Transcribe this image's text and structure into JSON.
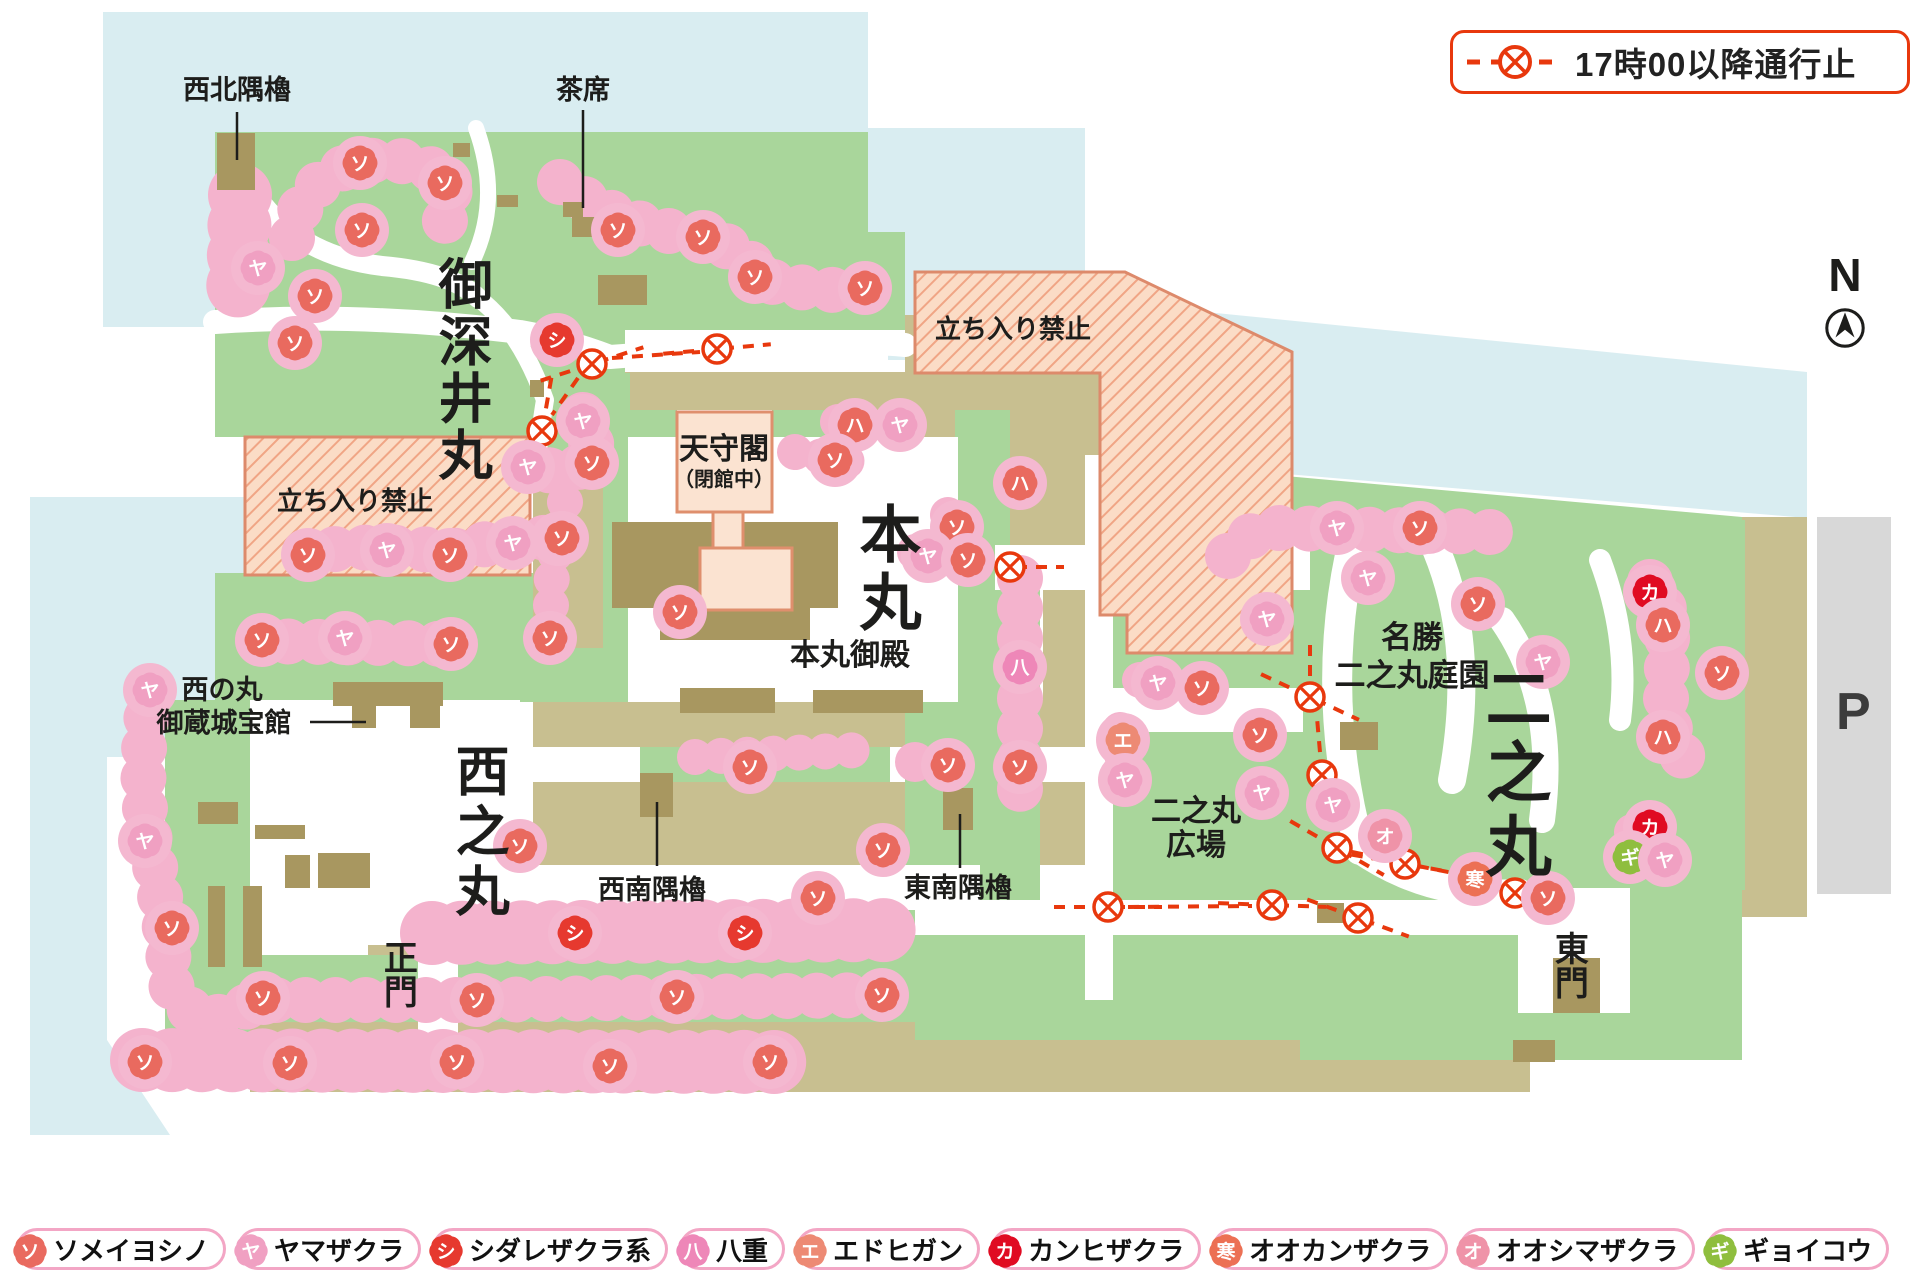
{
  "notice": {
    "label": "17時00以降通行止"
  },
  "compass": {
    "label": "N"
  },
  "parking": {
    "label": "P"
  },
  "labels": {
    "seihoku": "西北隅櫓",
    "chaseki": "茶席",
    "ofukemaru": "御深井丸",
    "no_entry": "立ち入り禁止",
    "tenshukaku": "天守閣",
    "tenshukaku_sub": "（閉館中）",
    "honmaru": "本丸",
    "honmaru_goten": "本丸御殿",
    "meisho1": "名勝",
    "meisho2": "二之丸庭園",
    "ninomaru": "二之丸",
    "hiroba1": "二之丸",
    "hiroba2": "広場",
    "kura1": "西の丸",
    "kura2": "御蔵城宝館",
    "nishinomaru": "西之丸",
    "seinan": "西南隅櫓",
    "tonan": "東南隅櫓",
    "seimon": "正門",
    "higashimon": "東門"
  },
  "species_legend": [
    {
      "code": "ソ",
      "name": "ソメイヨシノ",
      "color": "#e96a5f"
    },
    {
      "code": "ヤ",
      "name": "ヤマザクラ",
      "color": "#f0a0c2"
    },
    {
      "code": "シ",
      "name": "シダレザクラ系",
      "color": "#e6392f"
    },
    {
      "code": "八",
      "name": "八重",
      "color": "#ee87b8"
    },
    {
      "code": "エ",
      "name": "エドヒガン",
      "color": "#ed8a74"
    },
    {
      "code": "カ",
      "name": "カンヒザクラ",
      "color": "#e00b22"
    },
    {
      "code": "寒",
      "name": "オオカンザクラ",
      "color": "#ec7054"
    },
    {
      "code": "オ",
      "name": "オオシマザクラ",
      "color": "#ef93a8"
    },
    {
      "code": "ギ",
      "name": "ギョイコウ",
      "color": "#8fbe3e"
    }
  ],
  "markers": [
    {
      "c": "ソ",
      "x": 360,
      "y": 163
    },
    {
      "c": "ソ",
      "x": 445,
      "y": 183
    },
    {
      "c": "ソ",
      "x": 362,
      "y": 230
    },
    {
      "c": "ヤ",
      "x": 258,
      "y": 268
    },
    {
      "c": "ソ",
      "x": 315,
      "y": 296
    },
    {
      "c": "ソ",
      "x": 295,
      "y": 343
    },
    {
      "c": "シ",
      "x": 557,
      "y": 340
    },
    {
      "c": "ヤ",
      "x": 583,
      "y": 421
    },
    {
      "c": "ソ",
      "x": 592,
      "y": 463
    },
    {
      "c": "ヤ",
      "x": 528,
      "y": 467
    },
    {
      "c": "ソ",
      "x": 618,
      "y": 230
    },
    {
      "c": "ソ",
      "x": 703,
      "y": 237
    },
    {
      "c": "ソ",
      "x": 755,
      "y": 277
    },
    {
      "c": "ソ",
      "x": 865,
      "y": 288
    },
    {
      "c": "ソ",
      "x": 308,
      "y": 555
    },
    {
      "c": "ヤ",
      "x": 387,
      "y": 550
    },
    {
      "c": "ソ",
      "x": 450,
      "y": 555
    },
    {
      "c": "ヤ",
      "x": 513,
      "y": 543
    },
    {
      "c": "ソ",
      "x": 558,
      "y": 539
    },
    {
      "c": "ハ",
      "x": 855,
      "y": 425
    },
    {
      "c": "ヤ",
      "x": 900,
      "y": 425
    },
    {
      "c": "ソ",
      "x": 835,
      "y": 460
    },
    {
      "c": "ハ",
      "x": 1020,
      "y": 483
    },
    {
      "c": "ソ",
      "x": 957,
      "y": 527
    },
    {
      "c": "ソ",
      "x": 562,
      "y": 538
    },
    {
      "c": "ソ",
      "x": 550,
      "y": 638
    },
    {
      "c": "ソ",
      "x": 680,
      "y": 612
    },
    {
      "c": "八",
      "x": 1020,
      "y": 667
    },
    {
      "c": "ソ",
      "x": 1020,
      "y": 767
    },
    {
      "c": "ソ",
      "x": 750,
      "y": 767
    },
    {
      "c": "ソ",
      "x": 883,
      "y": 850
    },
    {
      "c": "ソ",
      "x": 818,
      "y": 898
    },
    {
      "c": "ソ",
      "x": 948,
      "y": 765
    },
    {
      "c": "ヤ",
      "x": 150,
      "y": 690
    },
    {
      "c": "ソ",
      "x": 262,
      "y": 640
    },
    {
      "c": "ヤ",
      "x": 345,
      "y": 638
    },
    {
      "c": "ソ",
      "x": 451,
      "y": 644
    },
    {
      "c": "ヤ",
      "x": 145,
      "y": 841
    },
    {
      "c": "ソ",
      "x": 172,
      "y": 928
    },
    {
      "c": "ソ",
      "x": 520,
      "y": 846
    },
    {
      "c": "ソ",
      "x": 145,
      "y": 1062
    },
    {
      "c": "ソ",
      "x": 290,
      "y": 1063
    },
    {
      "c": "ソ",
      "x": 457,
      "y": 1062
    },
    {
      "c": "ソ",
      "x": 610,
      "y": 1066
    },
    {
      "c": "ソ",
      "x": 770,
      "y": 1062
    },
    {
      "c": "シ",
      "x": 575,
      "y": 933
    },
    {
      "c": "シ",
      "x": 745,
      "y": 933
    },
    {
      "c": "ソ",
      "x": 263,
      "y": 998
    },
    {
      "c": "ソ",
      "x": 477,
      "y": 1000
    },
    {
      "c": "ソ",
      "x": 677,
      "y": 997
    },
    {
      "c": "ソ",
      "x": 882,
      "y": 995
    },
    {
      "c": "ヤ",
      "x": 928,
      "y": 556
    },
    {
      "c": "ソ",
      "x": 968,
      "y": 560
    },
    {
      "c": "ヤ",
      "x": 1158,
      "y": 683
    },
    {
      "c": "ソ",
      "x": 1202,
      "y": 688
    },
    {
      "c": "エ",
      "x": 1123,
      "y": 740
    },
    {
      "c": "ヤ",
      "x": 1125,
      "y": 780
    },
    {
      "c": "ヤ",
      "x": 1337,
      "y": 528
    },
    {
      "c": "ソ",
      "x": 1420,
      "y": 528
    },
    {
      "c": "ヤ",
      "x": 1368,
      "y": 578
    },
    {
      "c": "ソ",
      "x": 1478,
      "y": 604
    },
    {
      "c": "ヤ",
      "x": 1267,
      "y": 619
    },
    {
      "c": "ソ",
      "x": 1260,
      "y": 735
    },
    {
      "c": "ヤ",
      "x": 1262,
      "y": 793
    },
    {
      "c": "ヤ",
      "x": 1333,
      "y": 805
    },
    {
      "c": "オ",
      "x": 1385,
      "y": 836
    },
    {
      "c": "寒",
      "x": 1475,
      "y": 879
    },
    {
      "c": "ソ",
      "x": 1548,
      "y": 898
    },
    {
      "c": "カ",
      "x": 1650,
      "y": 592
    },
    {
      "c": "ハ",
      "x": 1663,
      "y": 625
    },
    {
      "c": "ソ",
      "x": 1722,
      "y": 673
    },
    {
      "c": "ハ",
      "x": 1663,
      "y": 737
    },
    {
      "c": "ヤ",
      "x": 1543,
      "y": 662
    },
    {
      "c": "カ",
      "x": 1650,
      "y": 827
    },
    {
      "c": "ギ",
      "x": 1630,
      "y": 857
    },
    {
      "c": "ヤ",
      "x": 1665,
      "y": 860
    }
  ],
  "closure_gates": [
    {
      "x": 592,
      "y": 364,
      "a": -18
    },
    {
      "x": 717,
      "y": 349,
      "a": -5
    },
    {
      "x": 542,
      "y": 431,
      "a": 100
    },
    {
      "x": 1010,
      "y": 567,
      "a": 0
    },
    {
      "x": 1310,
      "y": 697,
      "a": 25
    },
    {
      "x": 1322,
      "y": 775,
      "a": 85
    },
    {
      "x": 1337,
      "y": 848,
      "a": 30
    },
    {
      "x": 1405,
      "y": 864,
      "a": 10
    },
    {
      "x": 1515,
      "y": 893,
      "a": 18
    },
    {
      "x": 1108,
      "y": 907,
      "a": 0
    },
    {
      "x": 1272,
      "y": 905,
      "a": 2
    },
    {
      "x": 1358,
      "y": 918,
      "a": 20
    }
  ]
}
